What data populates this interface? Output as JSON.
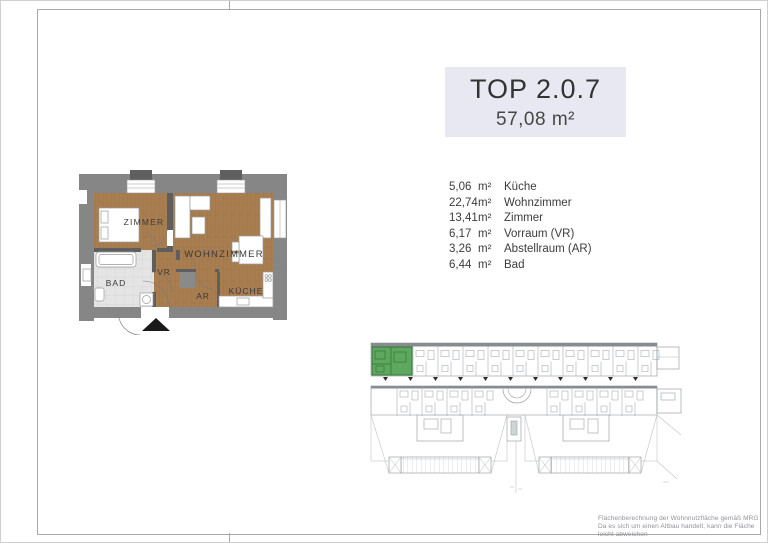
{
  "header": {
    "unit": "TOP 2.0.7",
    "total_area": "57,08 m²"
  },
  "rooms": [
    {
      "area": "5,06",
      "unit": "m²",
      "name": "Küche"
    },
    {
      "area": "22,74",
      "unit": "m²",
      "name": "Wohnzimmer"
    },
    {
      "area": "13,41",
      "unit": "m²",
      "name": "Zimmer"
    },
    {
      "area": "6,17",
      "unit": "m²",
      "name": "Vorraum (VR)"
    },
    {
      "area": "3,26",
      "unit": "m²",
      "name": "Abstellraum (AR)"
    },
    {
      "area": "6,44",
      "unit": "m²",
      "name": "Bad"
    }
  ],
  "floorplan": {
    "labels": {
      "zimmer": "ZIMMER",
      "wohnzimmer": "WOHNZIMMER",
      "bad": "BAD",
      "vr": "VR",
      "ar": "AR",
      "kueche": "KÜCHE"
    }
  },
  "footer": {
    "line1": "Flächenberechnung der Wohnnutzfläche gemäß MRG",
    "line2": "Da es sich um einen Altbau handelt, kann die Fläche leicht abweichen"
  },
  "colors": {
    "title_bg": "#e8e8f2",
    "wood_floor": "#a87e50",
    "tile_floor": "#e4e4e4",
    "wall_grey": "#868686",
    "highlight_green": "#5ea75e",
    "siteplan_line": "#9ba1a6"
  }
}
